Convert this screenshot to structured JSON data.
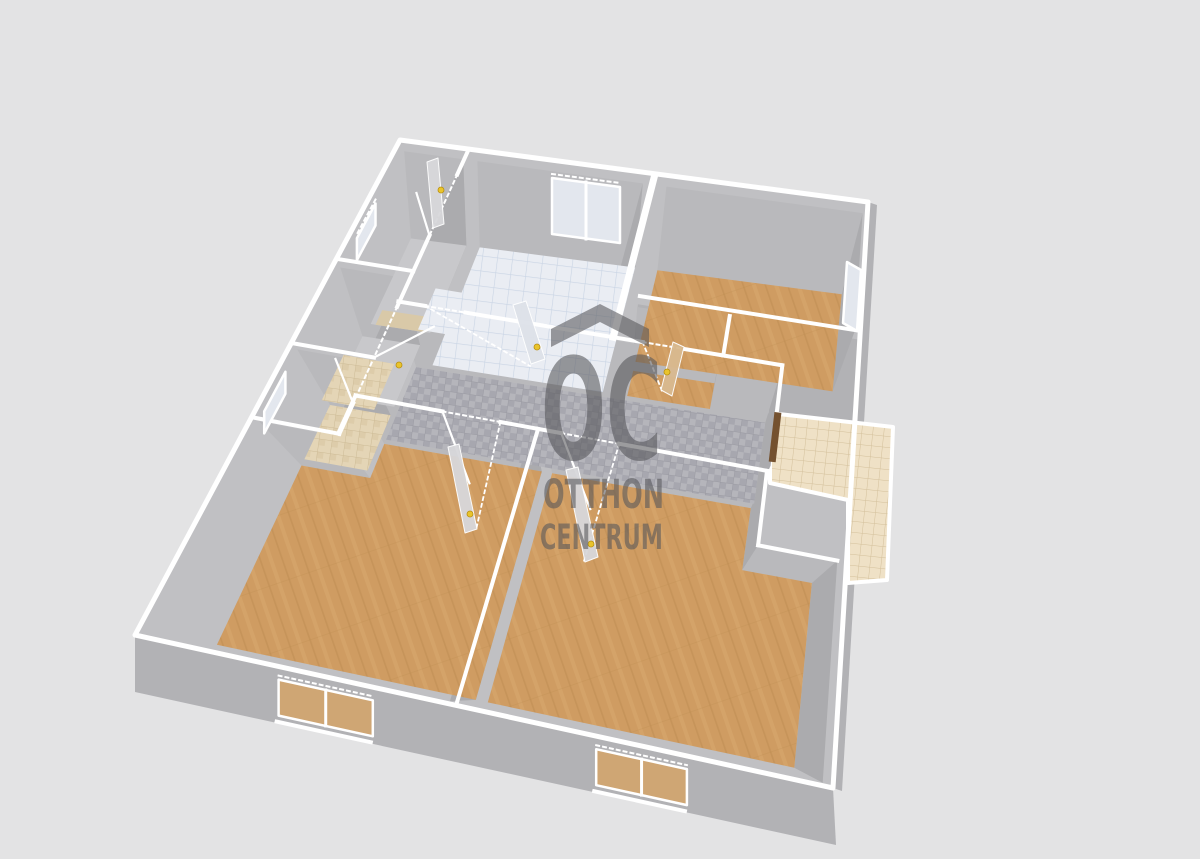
{
  "view": {
    "type": "3d-floorplan-render",
    "description": "Isometric doll-house view of an apartment floor plan",
    "background_color": "#e3e3e4"
  },
  "watermark": {
    "logo": "OC",
    "line1": "OTTHON",
    "line2": "CENTRUM",
    "color": "#56565a"
  },
  "palette": {
    "background": "#e3e3e4",
    "wallOuter": "#b2b2b5",
    "wallSlab": "#c0c0c3",
    "wallInnerNorth": "#b9b9bc",
    "wallInnerEast": "#ababae",
    "capWhite": "#ffffff",
    "floorPlain": "#c8c8cb",
    "floorStrip": "#d9c9a8",
    "wood": "#cf9c62",
    "woodSeam": "#b9894f",
    "bathTile": "#eaedf3",
    "bathTileLine": "#c9d4e4",
    "mosaicA": "#b5b5bb",
    "mosaicB": "#a7a7af",
    "mosaicLine": "#9a9aa2",
    "terraceTile": "#efe1c6",
    "terraceLine": "#d3c09b",
    "wcTile": "#e4d5b6",
    "wcTileLine": "#cdbb96",
    "doorPanel": "#d8d8db",
    "doorGlass": "#dee2e9",
    "doorWood": "#d9ba90",
    "doorTerrace": "#74512f",
    "handle": "#e9c42c",
    "windowPane": "#e3e7ee",
    "windowWoodPane": "#cfa674"
  },
  "rooms": [
    {
      "id": "hall-top-left",
      "floor": "plain"
    },
    {
      "id": "room-left",
      "floor": "plain"
    },
    {
      "id": "wc",
      "floor": "wc-tile"
    },
    {
      "id": "bathroom",
      "floor": "bath-tile"
    },
    {
      "id": "pantry",
      "floor": "wood"
    },
    {
      "id": "room-top-right",
      "floor": "wood"
    },
    {
      "id": "corridor",
      "floor": "mosaic"
    },
    {
      "id": "room-bottom-left",
      "floor": "wood"
    },
    {
      "id": "room-bottom-right",
      "floor": "wood"
    },
    {
      "id": "terrace",
      "floor": "terrace-tile"
    }
  ],
  "openings": {
    "windows": 6,
    "doors": 8
  }
}
